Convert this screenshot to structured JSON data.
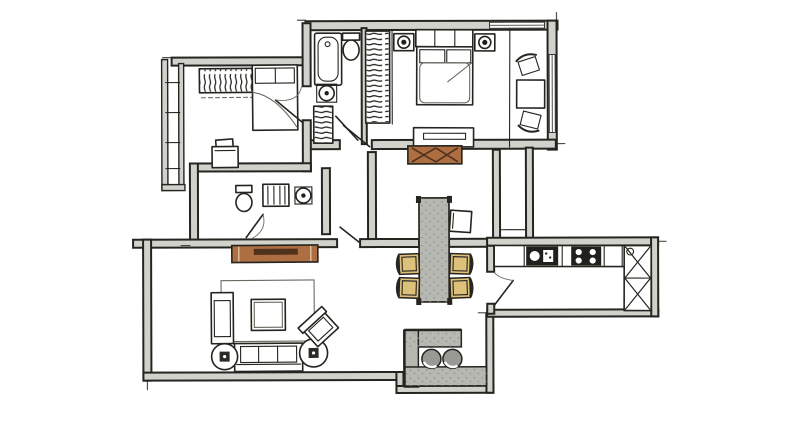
{
  "meta": {
    "title": "Hand-drawn apartment floor plan sketch, top-down view",
    "canvas": {
      "width": 800,
      "height": 422
    }
  },
  "palette": {
    "paper": "#ffffff",
    "ink": "#26241f",
    "ink_soft": "#6b6960",
    "wall_fill": "#d2d2cc",
    "wood": "#ad6e41",
    "wood_dark": "#4f311c",
    "chair_tan": "#ddc07a",
    "counter_gray": "#b8b8b2",
    "stool_gray": "#9a9a95",
    "fixture_dark": "#21201c",
    "speck_dot": "#8d8d85"
  },
  "plan": {
    "style": "ink sketch with gray poche walls and colored furniture accents",
    "rooms": [
      {
        "id": "bedroom-small",
        "furniture": [
          "wardrobe with hanging clothes",
          "single bed with pillow",
          "desk with chair",
          "balcony window wall",
          "door swing"
        ]
      },
      {
        "id": "bathroom-top",
        "furniture": [
          "bathtub",
          "toilet",
          "washbasin",
          "linen shelf",
          "door leaf"
        ]
      },
      {
        "id": "walk-in-closet",
        "furniture": [
          "hanging rail full height"
        ]
      },
      {
        "id": "master-bedroom",
        "furniture": [
          "double bed with headboard",
          "nightstand with lamp (left)",
          "nightstand with lamp (right)",
          "low dresser",
          "table with two chairs at window",
          "window in top wall",
          "window in right wall",
          "door leaf"
        ]
      },
      {
        "id": "hallway",
        "furniture": [
          "wooden console with X-braced front",
          "door leaf to living room"
        ]
      },
      {
        "id": "bathroom-middle",
        "furniture": [
          "toilet",
          "shower / appliance box",
          "washbasin",
          "door leaf"
        ]
      },
      {
        "id": "living-room",
        "furniture": [
          "wooden sideboard with tray",
          "area rug",
          "coffee table",
          "three-seat sofa",
          "round side table with lamp (left)",
          "round side table with lamp (right)",
          "lounge chair",
          "angled armchair"
        ]
      },
      {
        "id": "dining-area",
        "furniture": [
          "long speckled table with corner posts",
          "four tan upholstered chairs",
          "white head chair"
        ]
      },
      {
        "id": "kitchen",
        "furniture": [
          "counter run",
          "sink unit",
          "cooktop with four burners",
          "tall cabinet with X doors",
          "service door leaf"
        ]
      },
      {
        "id": "balcony-bar",
        "furniture": [
          "L-shaped gray counter",
          "two round stools"
        ]
      },
      {
        "id": "service-shaft",
        "furniture": [
          "double-wall duct"
        ]
      }
    ]
  }
}
